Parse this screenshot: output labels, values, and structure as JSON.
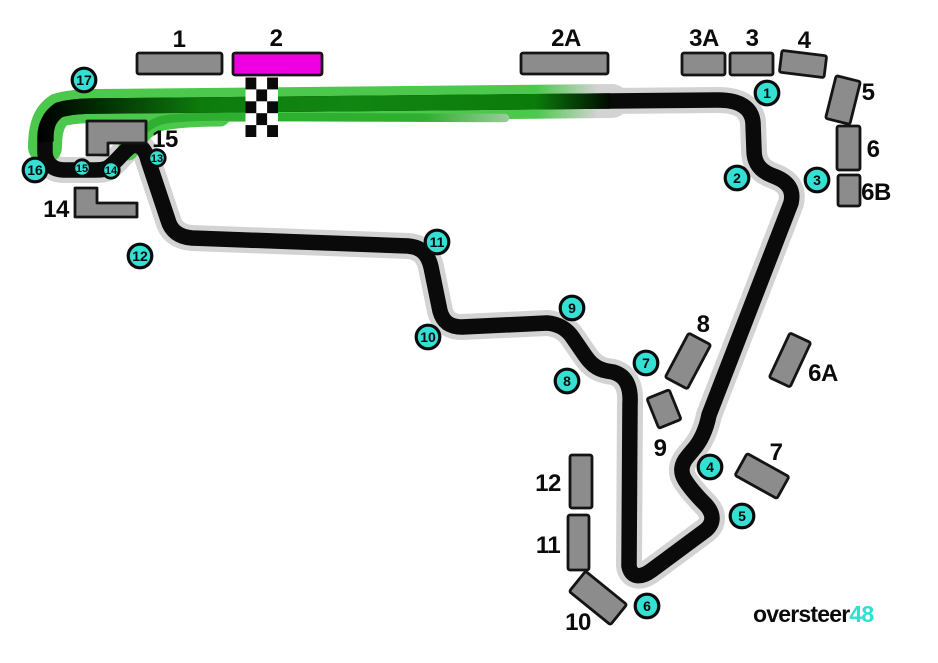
{
  "logo": {
    "black": "oversteer",
    "cyan": "48"
  },
  "colors": {
    "corner_marker": "#34E0D3",
    "accent_magenta": "#EE00E0",
    "grandstand_gray": "#8C8C8C",
    "track_black": "#0A0A0A",
    "halo_gray": "#D3D3D3",
    "straight_green": "#4CC84C",
    "speed_green": "#108610",
    "logo_cyan": "#2BE0D0"
  },
  "corners": {
    "c1": "1",
    "c2": "2",
    "c3": "3",
    "c4": "4",
    "c5": "5",
    "c6": "6",
    "c7": "7",
    "c8": "8",
    "c9": "9",
    "c10": "10",
    "c11": "11",
    "c12": "12",
    "c13": "13",
    "c14": "14",
    "c15": "15",
    "c16": "16",
    "c17": "17"
  },
  "grandstands": {
    "gs1": "1",
    "gs2": "2",
    "gs2a": "2A",
    "gs3a": "3A",
    "gs3": "3",
    "gs4": "4",
    "gs5": "5",
    "gs6": "6",
    "gs6b": "6B",
    "gs6a": "6A",
    "gs7": "7",
    "gs8": "8",
    "gs9": "9",
    "gs10": "10",
    "gs11": "11",
    "gs12": "12",
    "gs14": "14",
    "gs15": "15"
  }
}
